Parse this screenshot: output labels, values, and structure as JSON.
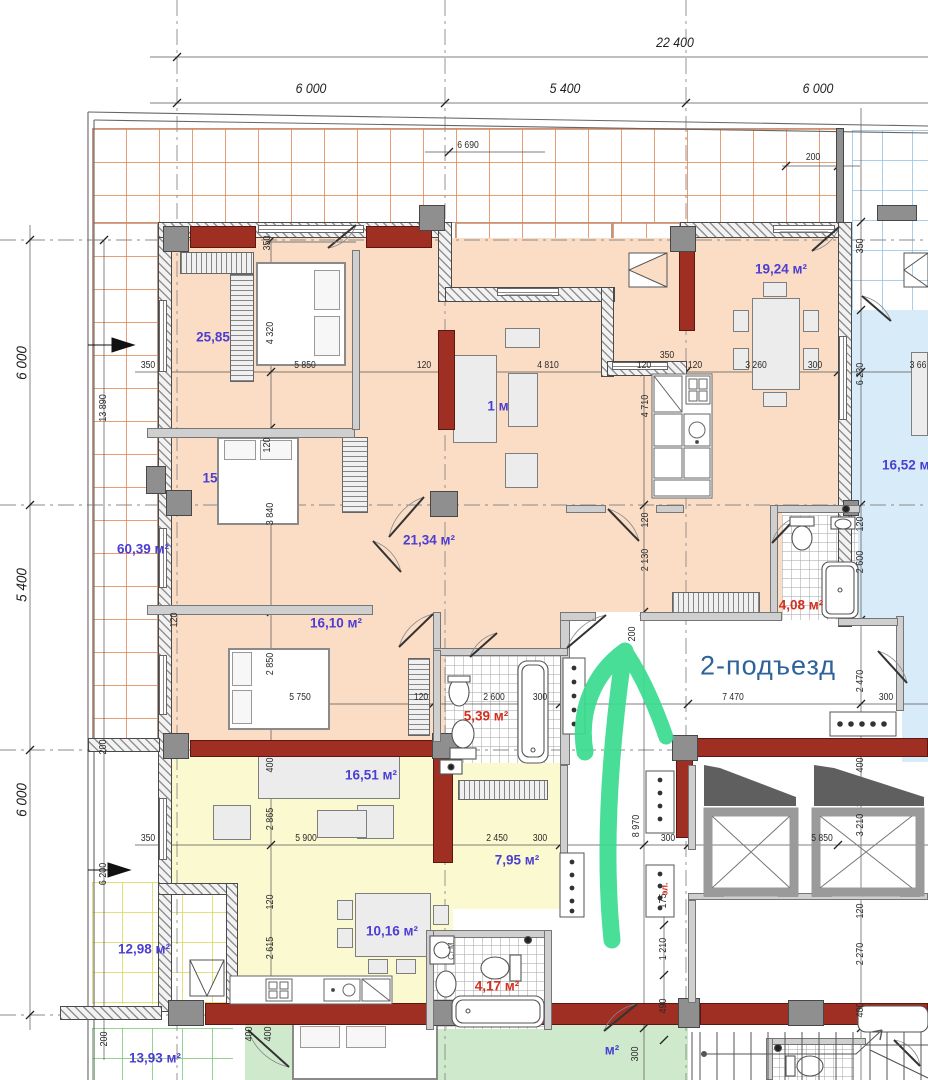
{
  "drawing": {
    "type": "architectural-floor-plan",
    "entrance_label": "2-подъезд",
    "arrow_color": "#3adc90",
    "palette": {
      "apartment1_fill": "#fbdcc5",
      "apartment2_fill": "#fbf9cf",
      "apartment3_fill": "#cfe9cc",
      "room_right_fill": "#d8ebf8",
      "structural_wall": "#9e2f22",
      "room_label_blue": "#4b3ed2",
      "room_label_red": "#d42f1f",
      "entrance_text": "#2d6398"
    }
  },
  "grid_dimensions": {
    "top_total": "22 400",
    "top_segments": [
      "6 000",
      "5 400",
      "6 000"
    ],
    "left_segments": [
      "6 000",
      "5 400",
      "6 000"
    ]
  },
  "rooms": [
    {
      "name": "bedroom-1",
      "text": "25,85"
    },
    {
      "name": "bedroom-2-partial",
      "text": "15"
    },
    {
      "name": "living-room-partial",
      "text": "1 м"
    },
    {
      "name": "terrace-left",
      "text": "60,39 м²"
    },
    {
      "name": "hallway-1",
      "text": "21,34 м²"
    },
    {
      "name": "bedroom-3",
      "text": "16,10 м²"
    },
    {
      "name": "kitchen-dining",
      "text": "19,24 м²"
    },
    {
      "name": "room-right",
      "text": "16,52 м²"
    },
    {
      "name": "bathroom-1",
      "text": "4,08 м²"
    },
    {
      "name": "bathroom-2",
      "text": "5,39 м²"
    },
    {
      "name": "living-room-2",
      "text": "16,51 м²"
    },
    {
      "name": "hallway-2",
      "text": "7,95 м²"
    },
    {
      "name": "kitchen-dining-2",
      "text": "10,16 м²"
    },
    {
      "name": "terrace-2",
      "text": "12,98 м²"
    },
    {
      "name": "bathroom-3",
      "text": "4,17 м²"
    },
    {
      "name": "terrace-3",
      "text": "13,93 м²"
    },
    {
      "name": "bedroom-4-partial",
      "text": "м²"
    },
    {
      "name": "shaft-electrical",
      "text": "эл."
    },
    {
      "name": "washing-machine",
      "text": "Ст.М."
    }
  ],
  "dims": [
    "22 400",
    "6 000",
    "5 400",
    "6 000",
    "6 690",
    "200",
    "350",
    "350",
    "4 320",
    "13 890",
    "350",
    "5 850",
    "120",
    "4 810",
    "120",
    "350",
    "120",
    "3 260",
    "300",
    "3 66",
    "6 230",
    "4 710",
    "120",
    "3 840",
    "120",
    "2 600",
    "120",
    "2 130",
    "120",
    "2 850",
    "200",
    "2 470",
    "5 750",
    "120",
    "2 600",
    "300",
    "7 470",
    "300",
    "200",
    "400",
    "400",
    "2 865",
    "350",
    "5 900",
    "2 450",
    "300",
    "300",
    "5 850",
    "8 970",
    "3 210",
    "6 200",
    "120",
    "2 615",
    "175",
    "1 210",
    "490",
    "120",
    "2 270",
    "400",
    "300",
    "400",
    "400",
    "200"
  ]
}
